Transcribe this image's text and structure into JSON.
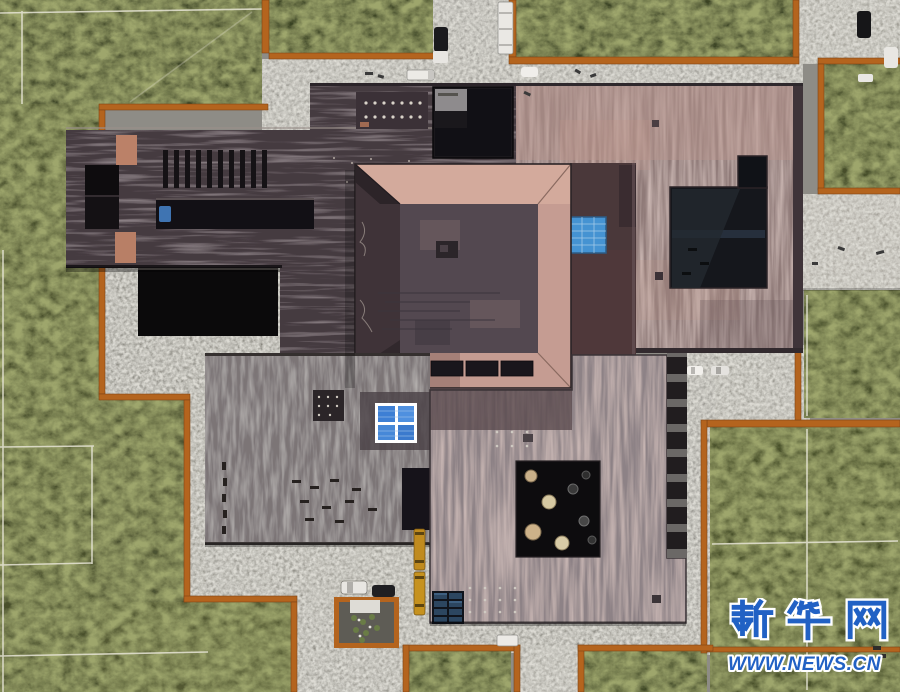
{
  "scene": {
    "type": "aerial-photograph",
    "subject": "Top-down drone view of a museum complex: dark plum tiled roofs, a square pink hip-roof pavilion, pink-mauve exhibition hall with sunken courtyards, grass fields edged with corten steel, concrete paths, parked cars, trucks and service equipment"
  },
  "watermark": {
    "line1": "新华网",
    "line2": "WWW.NEWS.CN",
    "text_color": "#2161c4",
    "outline_color": "#ffffff"
  },
  "colors": {
    "grass_dark": "#3d4526",
    "grass_light": "#5a6234",
    "corten_edge": "#b4641e",
    "concrete": "#98968f",
    "roof_dark_plum": "#453a40",
    "roof_mauve_pink": "#8f7a78",
    "pavilion_pink": "#d3aa9c",
    "pavilion_core": "#534850",
    "skylight_blue": "#4593d2",
    "window_blue": "#3d7fd4",
    "courtyard_black": "#0d0c0e",
    "bus_yellow": "#c08b1f"
  },
  "objects": {
    "vehicle_count": 15,
    "umbrella_count": 8,
    "roof_vent_slits": 10
  }
}
